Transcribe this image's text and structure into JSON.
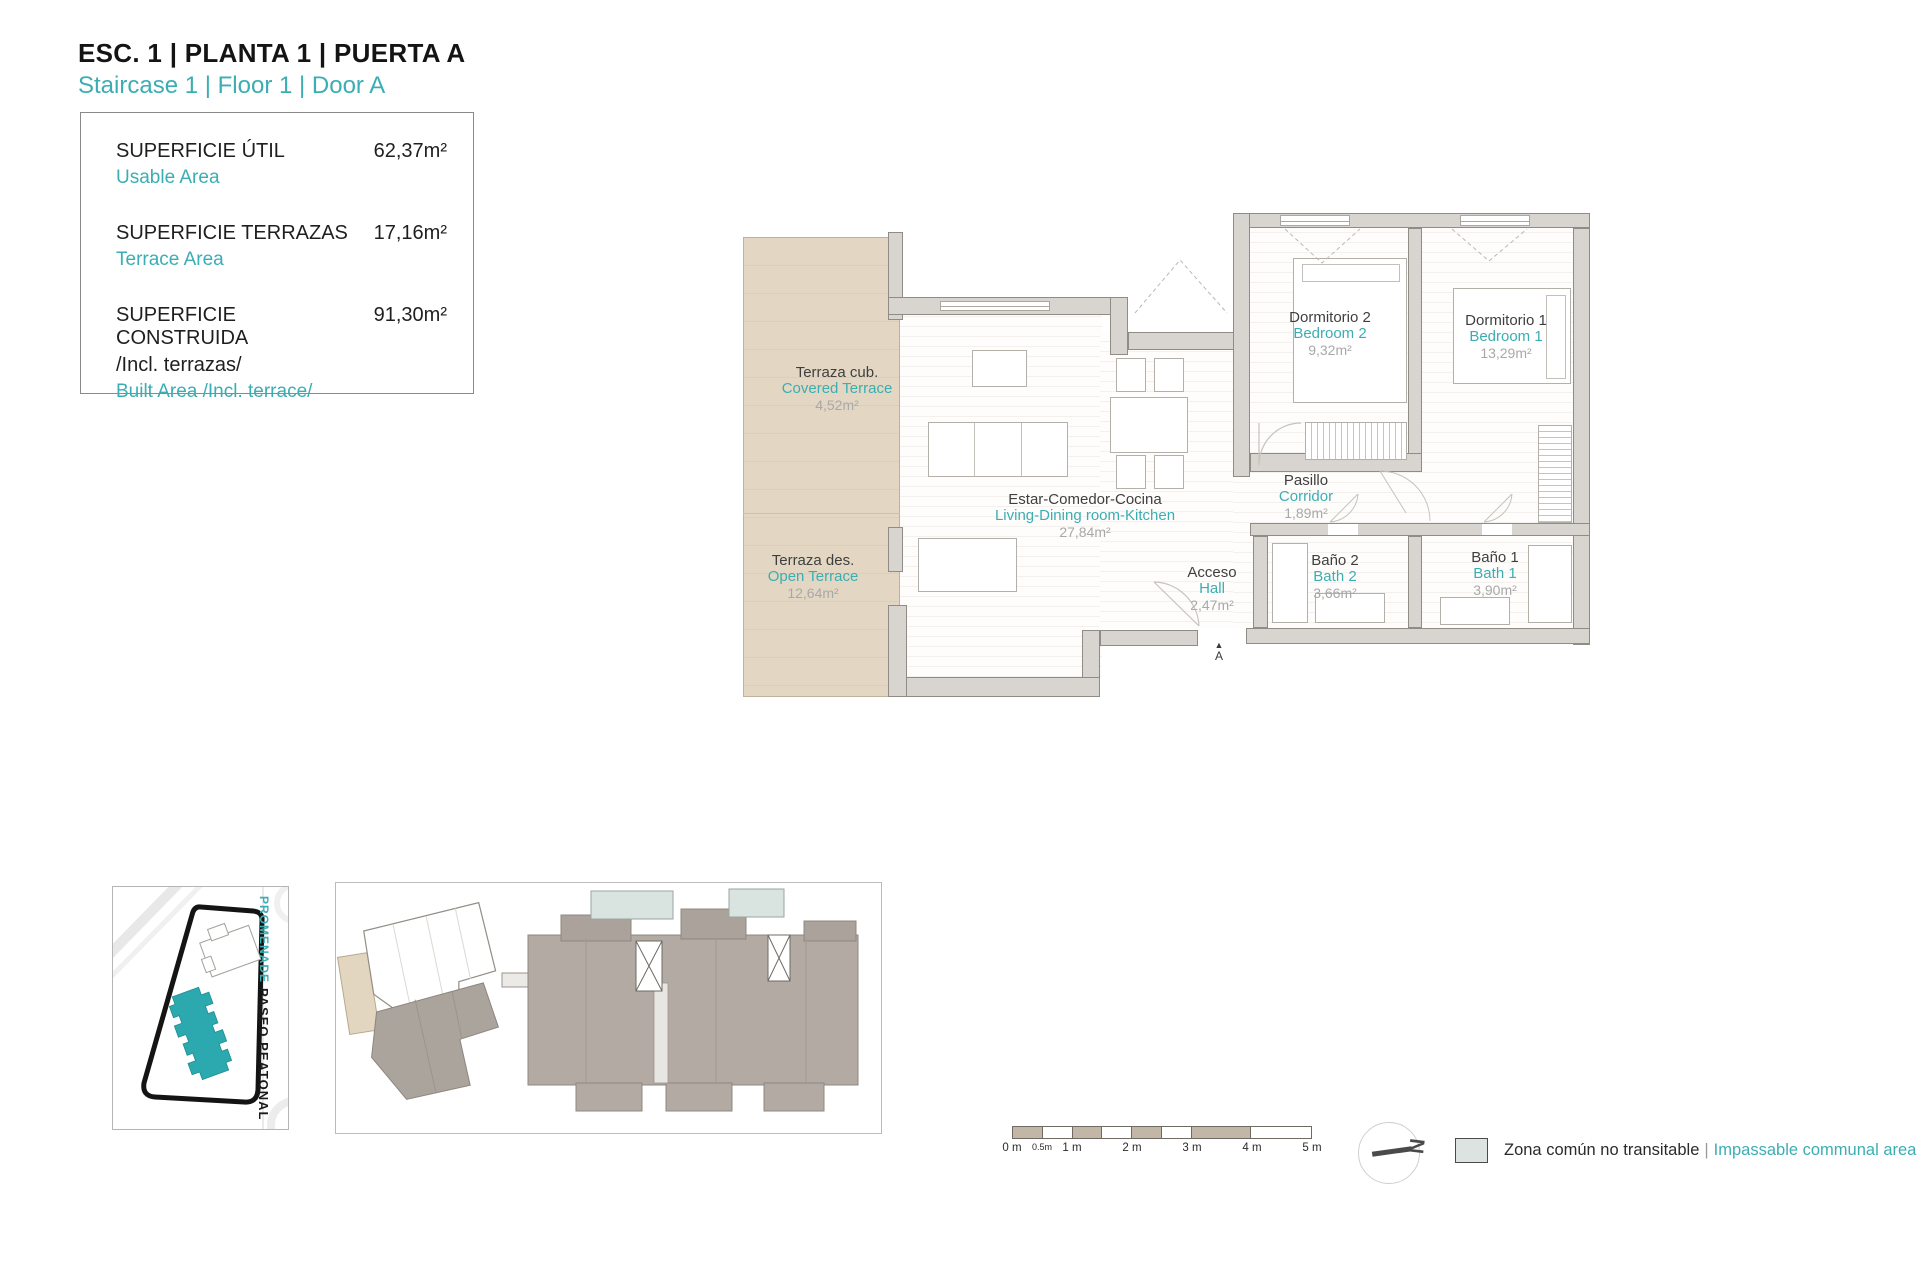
{
  "header": {
    "title_es": "ESC. 1 | PLANTA 1 | PUERTA A",
    "title_en": "Staircase 1 | Floor 1 | Door A"
  },
  "summary": {
    "rows": [
      {
        "label_es": "SUPERFICIE ÚTIL",
        "label_en": "Usable Area",
        "value": "62,37m²"
      },
      {
        "label_es": "SUPERFICIE TERRAZAS",
        "label_en": "Terrace Area",
        "value": "17,16m²"
      },
      {
        "label_es": "SUPERFICIE CONSTRUIDA",
        "label_es_note": "/Incl. terrazas/",
        "label_en": "Built Area /Incl. terrace/",
        "value": "91,30m²"
      }
    ]
  },
  "rooms": [
    {
      "id": "covered-terrace",
      "name_es": "Terraza cub.",
      "name_en": "Covered Terrace",
      "area": "4,52m²"
    },
    {
      "id": "open-terrace",
      "name_es": "Terraza des.",
      "name_en": "Open Terrace",
      "area": "12,64m²"
    },
    {
      "id": "living",
      "name_es": "Estar-Comedor-Cocina",
      "name_en": "Living-Dining room-Kitchen",
      "area": "27,84m²"
    },
    {
      "id": "bedroom2",
      "name_es": "Dormitorio 2",
      "name_en": "Bedroom 2",
      "area": "9,32m²"
    },
    {
      "id": "bedroom1",
      "name_es": "Dormitorio 1",
      "name_en": "Bedroom 1",
      "area": "13,29m²"
    },
    {
      "id": "corridor",
      "name_es": "Pasillo",
      "name_en": "Corridor",
      "area": "1,89m²"
    },
    {
      "id": "hall",
      "name_es": "Acceso",
      "name_en": "Hall",
      "area": "2,47m²"
    },
    {
      "id": "bath2",
      "name_es": "Baño 2",
      "name_en": "Bath 2",
      "area": "3,66m²"
    },
    {
      "id": "bath1",
      "name_es": "Baño 1",
      "name_en": "Bath 1",
      "area": "3,90m²"
    }
  ],
  "entrance": {
    "icon": "▲",
    "marker": "A"
  },
  "site_map": {
    "street_teal": "PROMENADE",
    "street_black": "PASEO PEATONAL"
  },
  "scale_bar": {
    "labels": [
      "0 m",
      "0.5m",
      "1 m",
      "2 m",
      "3 m",
      "4 m",
      "5 m"
    ]
  },
  "compass": {
    "north": "N"
  },
  "legend": {
    "label_es": "Zona común no transitable",
    "separator": "|",
    "label_en": "Impassable communal area"
  },
  "colors": {
    "accent_teal": "#3BAEB3",
    "terrace_tan": "#E3D7C3",
    "wall_gray": "#D8D5D0",
    "highlight_building_teal": "#2BA9AE",
    "legend_swatch": "#DDE3E0",
    "area_text_gray": "#A8A8A8"
  }
}
